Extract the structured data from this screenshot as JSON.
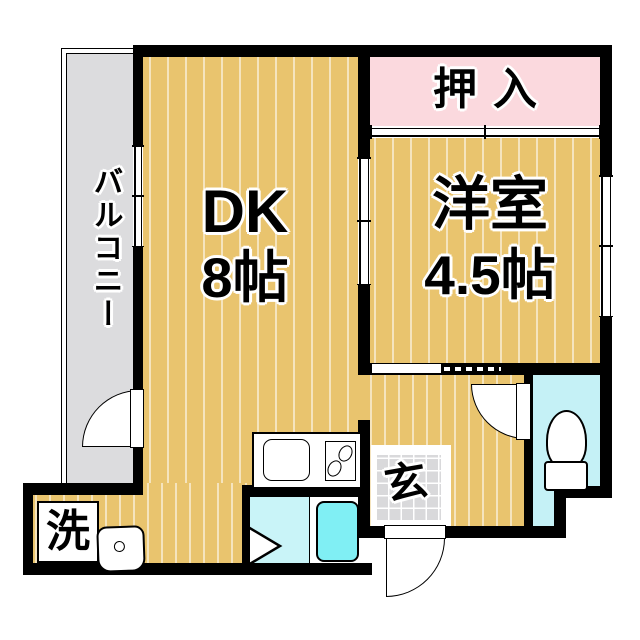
{
  "palette": {
    "wall": "#000000",
    "floor": "#e9c46e",
    "stripe": "rgba(255,255,255,0.55)",
    "balcony": "#dcdcde",
    "pink": "#fbd9de",
    "toiletcyan": "#c5f1f6",
    "showercyan": "#c9f4f8",
    "tubcyan": "#80eff4",
    "tile": "#d9d9db"
  },
  "rooms": {
    "balcony": {
      "label": "バルコニー"
    },
    "dk": {
      "label": "DK",
      "size": "8帖"
    },
    "western_room": {
      "label": "洋室",
      "size": "4.5帖"
    },
    "closet": {
      "label": "押入"
    },
    "entrance": {
      "label": "玄"
    },
    "laundry": {
      "label": "洗"
    }
  },
  "fixtures": {
    "toilet": "toilet",
    "bathtub": "bathtub",
    "shower_door": "folding-door-marker",
    "kitchen_sink": "kitchen-sink",
    "stove": "two-burner-stove",
    "washbasin": "washbasin"
  }
}
